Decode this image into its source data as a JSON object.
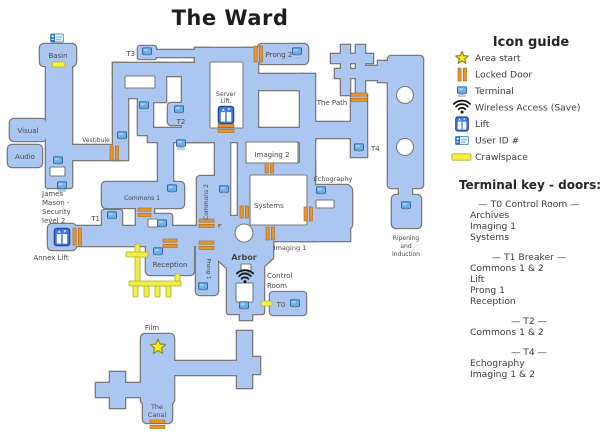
{
  "title": "The Ward",
  "colors": {
    "corridor": "#abc6f1",
    "outline": "#7a7a7a",
    "door": "#e8952f",
    "door_border": "#a8690f",
    "crawlspace": "#f3ee42",
    "crawlspace_border": "#b3ae36",
    "room_white": "#ffffff",
    "label": "#484848",
    "panel_text": "#3d3d3d",
    "heading_text": "#262626",
    "terminal_screen": "#6fb0ea",
    "terminal_border": "#2e5f9c",
    "lift_fill": "#4478dc",
    "lift_border": "#1c4da1",
    "star_fill": "#ffe81e",
    "star_border": "#8f8f25",
    "wifi": "#151515",
    "userid_fill": "#ddeff9",
    "userid_accent": "#2d74c4"
  },
  "map": {
    "labels": [
      {
        "text": "Basin",
        "x": 58,
        "y": 58
      },
      {
        "text": "Visual",
        "x": 28,
        "y": 133
      },
      {
        "text": "Audio",
        "x": 25,
        "y": 159
      },
      {
        "text": "Vestibule",
        "x": 96,
        "y": 142,
        "size": 6
      },
      {
        "text": "James",
        "x": 42,
        "y": 196,
        "anchor": "start"
      },
      {
        "text": "Mason -",
        "x": 42,
        "y": 205,
        "anchor": "start"
      },
      {
        "text": "Security",
        "x": 42,
        "y": 214,
        "anchor": "start"
      },
      {
        "text": "level 2",
        "x": 42,
        "y": 223,
        "anchor": "start"
      },
      {
        "text": "T3",
        "x": 135,
        "y": 56,
        "anchor": "end"
      },
      {
        "text": "T2",
        "x": 181,
        "y": 124
      },
      {
        "text": "Server",
        "x": 226,
        "y": 96,
        "size": 6
      },
      {
        "text": "Lift.",
        "x": 226,
        "y": 103,
        "size": 6
      },
      {
        "text": "Prong 2",
        "x": 279,
        "y": 57
      },
      {
        "text": "The Path",
        "x": 332,
        "y": 105
      },
      {
        "text": "T4",
        "x": 371,
        "y": 151,
        "anchor": "start"
      },
      {
        "text": "Imaging 2",
        "x": 272,
        "y": 157
      },
      {
        "text": "Systems",
        "x": 254,
        "y": 208,
        "anchor": "start"
      },
      {
        "text": "Echography",
        "x": 333,
        "y": 181,
        "size": 6.5
      },
      {
        "text": "Commons 1",
        "x": 142,
        "y": 200,
        "size": 6
      },
      {
        "text": "Commons 2",
        "x": 208,
        "y": 202,
        "rot": -90,
        "size": 6
      },
      {
        "text": "T1",
        "x": 100,
        "y": 221,
        "anchor": "end"
      },
      {
        "text": "Annex Lift",
        "x": 51,
        "y": 260,
        "size": 7
      },
      {
        "text": "Reception",
        "x": 170,
        "y": 267
      },
      {
        "text": "Prong 1",
        "x": 207,
        "y": 269,
        "rot": 90,
        "size": 5.5
      },
      {
        "text": "Arbor",
        "x": 244,
        "y": 260,
        "bold": true,
        "size": 8
      },
      {
        "text": "Imaging 1",
        "x": 290,
        "y": 250,
        "size": 6.5
      },
      {
        "text": "Control",
        "x": 267,
        "y": 278,
        "anchor": "start"
      },
      {
        "text": "Room",
        "x": 267,
        "y": 288,
        "anchor": "start"
      },
      {
        "text": "T0",
        "x": 281,
        "y": 307
      },
      {
        "text": "Ripening",
        "x": 406,
        "y": 240,
        "size": 6
      },
      {
        "text": "and",
        "x": 406,
        "y": 248,
        "size": 6
      },
      {
        "text": "Induction",
        "x": 406,
        "y": 256,
        "size": 6
      },
      {
        "text": "Film",
        "x": 152,
        "y": 330
      },
      {
        "text": "The",
        "x": 157,
        "y": 409,
        "size": 6.5
      },
      {
        "text": "Canal",
        "x": 157,
        "y": 417,
        "size": 6.5
      }
    ],
    "icons": [
      {
        "type": "user-id",
        "x": 57,
        "y": 38
      },
      {
        "type": "terminal",
        "x": 147,
        "y": 52
      },
      {
        "type": "terminal",
        "x": 297,
        "y": 52
      },
      {
        "type": "terminal",
        "x": 179,
        "y": 110
      },
      {
        "type": "terminal",
        "x": 144,
        "y": 106
      },
      {
        "type": "terminal",
        "x": 122,
        "y": 136
      },
      {
        "type": "terminal",
        "x": 58,
        "y": 161
      },
      {
        "type": "terminal",
        "x": 62,
        "y": 186
      },
      {
        "type": "terminal",
        "x": 181,
        "y": 144
      },
      {
        "type": "terminal",
        "x": 224,
        "y": 190
      },
      {
        "type": "terminal",
        "x": 172,
        "y": 189
      },
      {
        "type": "terminal",
        "x": 112,
        "y": 216
      },
      {
        "type": "terminal",
        "x": 162,
        "y": 224
      },
      {
        "type": "terminal",
        "x": 158,
        "y": 252
      },
      {
        "type": "terminal",
        "x": 203,
        "y": 287
      },
      {
        "type": "terminal",
        "x": 244,
        "y": 306
      },
      {
        "type": "terminal",
        "x": 295,
        "y": 304
      },
      {
        "type": "terminal",
        "x": 359,
        "y": 148
      },
      {
        "type": "terminal",
        "x": 321,
        "y": 191
      },
      {
        "type": "terminal",
        "x": 406,
        "y": 206
      },
      {
        "type": "lift",
        "x": 62,
        "y": 237
      },
      {
        "type": "lift",
        "x": 226,
        "y": 115
      },
      {
        "type": "wifi",
        "x": 245,
        "y": 277
      },
      {
        "type": "star",
        "x": 158,
        "y": 347,
        "r": 8
      }
    ],
    "doors": [
      {
        "x": 110,
        "y": 146,
        "o": "v",
        "l": 14
      },
      {
        "x": 73,
        "y": 228,
        "o": "v",
        "l": 17
      },
      {
        "x": 254,
        "y": 46,
        "o": "v",
        "l": 16
      },
      {
        "x": 218,
        "y": 124,
        "o": "h",
        "l": 16
      },
      {
        "x": 351,
        "y": 93,
        "o": "h",
        "l": 16
      },
      {
        "x": 265,
        "y": 163,
        "o": "v",
        "l": 10
      },
      {
        "x": 240,
        "y": 206,
        "o": "v",
        "l": 12
      },
      {
        "x": 266,
        "y": 227,
        "o": "v",
        "l": 13
      },
      {
        "x": 304,
        "y": 207,
        "o": "v",
        "l": 14
      },
      {
        "x": 138,
        "y": 208,
        "o": "h",
        "l": 13
      },
      {
        "x": 199,
        "y": 219,
        "o": "h",
        "l": 15
      },
      {
        "x": 163,
        "y": 239,
        "o": "h",
        "l": 14
      },
      {
        "x": 199,
        "y": 241,
        "o": "h",
        "l": 15
      },
      {
        "x": 150,
        "y": 420,
        "o": "h",
        "l": 15
      }
    ],
    "crawlspaces": [
      {
        "x": 52,
        "y": 62,
        "w": 13,
        "h": 5
      },
      {
        "x": 135,
        "y": 244,
        "w": 5,
        "h": 42
      },
      {
        "x": 126,
        "y": 252,
        "w": 22,
        "h": 5
      },
      {
        "x": 129,
        "y": 281,
        "w": 52,
        "h": 5
      },
      {
        "x": 133,
        "y": 286,
        "w": 5,
        "h": 11
      },
      {
        "x": 144,
        "y": 286,
        "w": 5,
        "h": 11
      },
      {
        "x": 155,
        "y": 286,
        "w": 5,
        "h": 11
      },
      {
        "x": 166,
        "y": 286,
        "w": 5,
        "h": 11
      },
      {
        "x": 175,
        "y": 274,
        "w": 5,
        "h": 7
      },
      {
        "x": 261,
        "y": 301,
        "w": 11,
        "h": 5
      }
    ]
  },
  "legend": {
    "heading": "Icon guide",
    "items": [
      {
        "icon": "area-start-star",
        "label": "Area start"
      },
      {
        "icon": "locked-door",
        "label": "Locked Door"
      },
      {
        "icon": "terminal",
        "label": "Terminal"
      },
      {
        "icon": "wireless",
        "label": "Wireless Access (Save)"
      },
      {
        "icon": "lift",
        "label": "Lift"
      },
      {
        "icon": "user-id",
        "label": "User ID #"
      },
      {
        "icon": "crawlspace",
        "label": "Crawlspace"
      }
    ]
  },
  "terminal_key": {
    "heading": "Terminal key - doors:",
    "sections": [
      {
        "header": "— T0 Control Room —",
        "entries": [
          "Archives",
          "Imaging 1",
          "Systems"
        ]
      },
      {
        "header": "— T1 Breaker —",
        "entries": [
          "Commons 1 & 2",
          "Lift",
          "Prong 1",
          "Reception"
        ]
      },
      {
        "header": "— T2 —",
        "entries": [
          "Commons 1 & 2"
        ]
      },
      {
        "header": "— T4 —",
        "entries": [
          "Echography",
          "Imaging 1 & 2"
        ]
      }
    ]
  }
}
